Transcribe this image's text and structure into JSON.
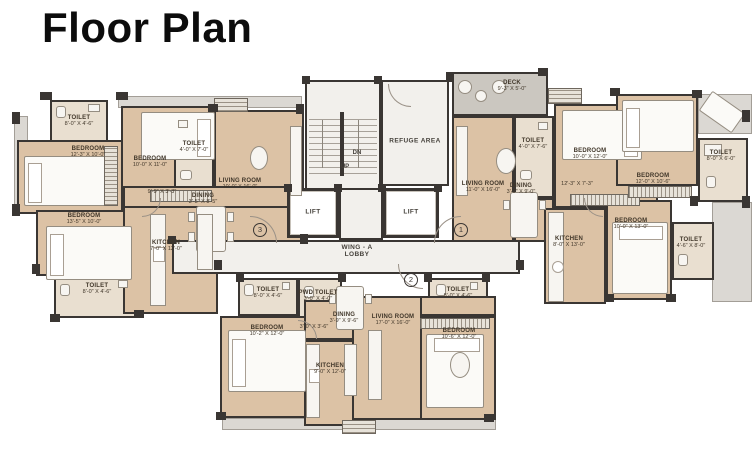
{
  "title": "Floor Plan",
  "colors": {
    "room_fill": "#dcc2a5",
    "wet_fill": "#e9dfd0",
    "core_fill": "#f2f0ec",
    "deck_fill": "#cbc7c0",
    "wall": "#3a3633"
  },
  "core": {
    "refuge": "REFUGE AREA",
    "lift_left": "LIFT",
    "lift_right": "LIFT",
    "stairs_down": "DN",
    "stairs_up": "UP",
    "lobby_line1": "WING - A",
    "lobby_line2": "LOBBY"
  },
  "unit_markers": {
    "left_wing": "3",
    "right_wing": "1",
    "bottom_wing": "2"
  },
  "rooms": [
    {
      "name": "TOILET",
      "dims": "8'-0\" X 4'-6\""
    },
    {
      "name": "BEDROOM",
      "dims": "12'-3\" X 10'-0\""
    },
    {
      "name": "BEDROOM",
      "dims": "10'-0\" X 11'-0\""
    },
    {
      "name": "TOILET",
      "dims": "4'-0\" X 7'-0\""
    },
    {
      "name": "LIVING ROOM",
      "dims": "10'-0\" X 16'-0\""
    },
    {
      "name": "DINING",
      "dims": "3'-5\" X 8'-5\""
    },
    {
      "name": "",
      "dims": "9'-9\" X 3'-3\""
    },
    {
      "name": "BEDROOM",
      "dims": "13'-5\" X 10'-0\""
    },
    {
      "name": "KITCHEN",
      "dims": "7'-0\" X 12'-0\""
    },
    {
      "name": "TOILET",
      "dims": "8'-0\" X 4'-6\""
    },
    {
      "name": "DECK",
      "dims": "9'-3\" X 5'-0\""
    },
    {
      "name": "TOILET",
      "dims": "4'-0\" X 7'-6\""
    },
    {
      "name": "BEDROOM",
      "dims": "10'-0\" X 12'-0\""
    },
    {
      "name": "TOILET",
      "dims": "8'-0\" X 6'-0\""
    },
    {
      "name": "LIVING ROOM",
      "dims": "11'-0\" X 16'-0\""
    },
    {
      "name": "DINING",
      "dims": "3'-9\" X 9'-0\""
    },
    {
      "name": "",
      "dims": "12'-3\" X 7'-3\""
    },
    {
      "name": "BEDROOM",
      "dims": "12'-0\" X 10'-6\""
    },
    {
      "name": "BEDROOM",
      "dims": "10'-0\" X 13'-0\""
    },
    {
      "name": "KITCHEN",
      "dims": "8'-0\" X 13'-0\""
    },
    {
      "name": "TOILET",
      "dims": "4'-6\" X 8'-0\""
    },
    {
      "name": "TOILET",
      "dims": "8'-0\" X 4'-6\""
    },
    {
      "name": "PWD TOILET",
      "dims": "3'-0\" X 4'-0\""
    },
    {
      "name": "",
      "dims": "3'-0\" X 3'-6\""
    },
    {
      "name": "DINING",
      "dims": "3'-9\" X 9'-6\""
    },
    {
      "name": "LIVING ROOM",
      "dims": "17'-0\" X 16'-0\""
    },
    {
      "name": "BEDROOM",
      "dims": "10'-2\" X 12'-0\""
    },
    {
      "name": "KITCHEN",
      "dims": "9'-0\" X 12'-0\""
    },
    {
      "name": "TOILET",
      "dims": "8'-0\" X 4'-6\""
    },
    {
      "name": "BEDROOM",
      "dims": "10'-6\" X 12'-0\""
    }
  ]
}
